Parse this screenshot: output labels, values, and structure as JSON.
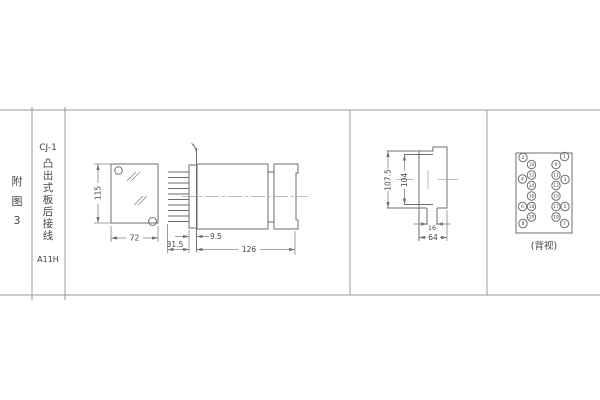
{
  "title_block": {
    "figure_chars": [
      "附",
      "图",
      "3"
    ],
    "figure_label": "附图3",
    "model": "CJ-1",
    "desc_chars": [
      "凸",
      "出",
      "式",
      "板",
      "后",
      "接",
      "线"
    ],
    "description": "凸出式板后接线",
    "code": "A11H"
  },
  "dims": {
    "front": {
      "height": "115",
      "width": "72"
    },
    "side": {
      "terminals": "31.5",
      "offset": "9.5",
      "length": "126"
    },
    "profile": {
      "height_outer": "107.5",
      "height_inner": "104",
      "slot": "16",
      "width": "64"
    }
  },
  "rear_view": {
    "caption": "(背视)",
    "pins": [
      "2",
      "4",
      "6",
      "8",
      "10",
      "12",
      "14",
      "16",
      "18",
      "20",
      "9",
      "11",
      "13",
      "15",
      "17",
      "19",
      "1",
      "3",
      "5",
      "7"
    ]
  },
  "colors": {
    "background": "#ffffff",
    "linework": "#6e6e6e",
    "grid_lines": "#9a9a9a",
    "text": "#454545"
  }
}
